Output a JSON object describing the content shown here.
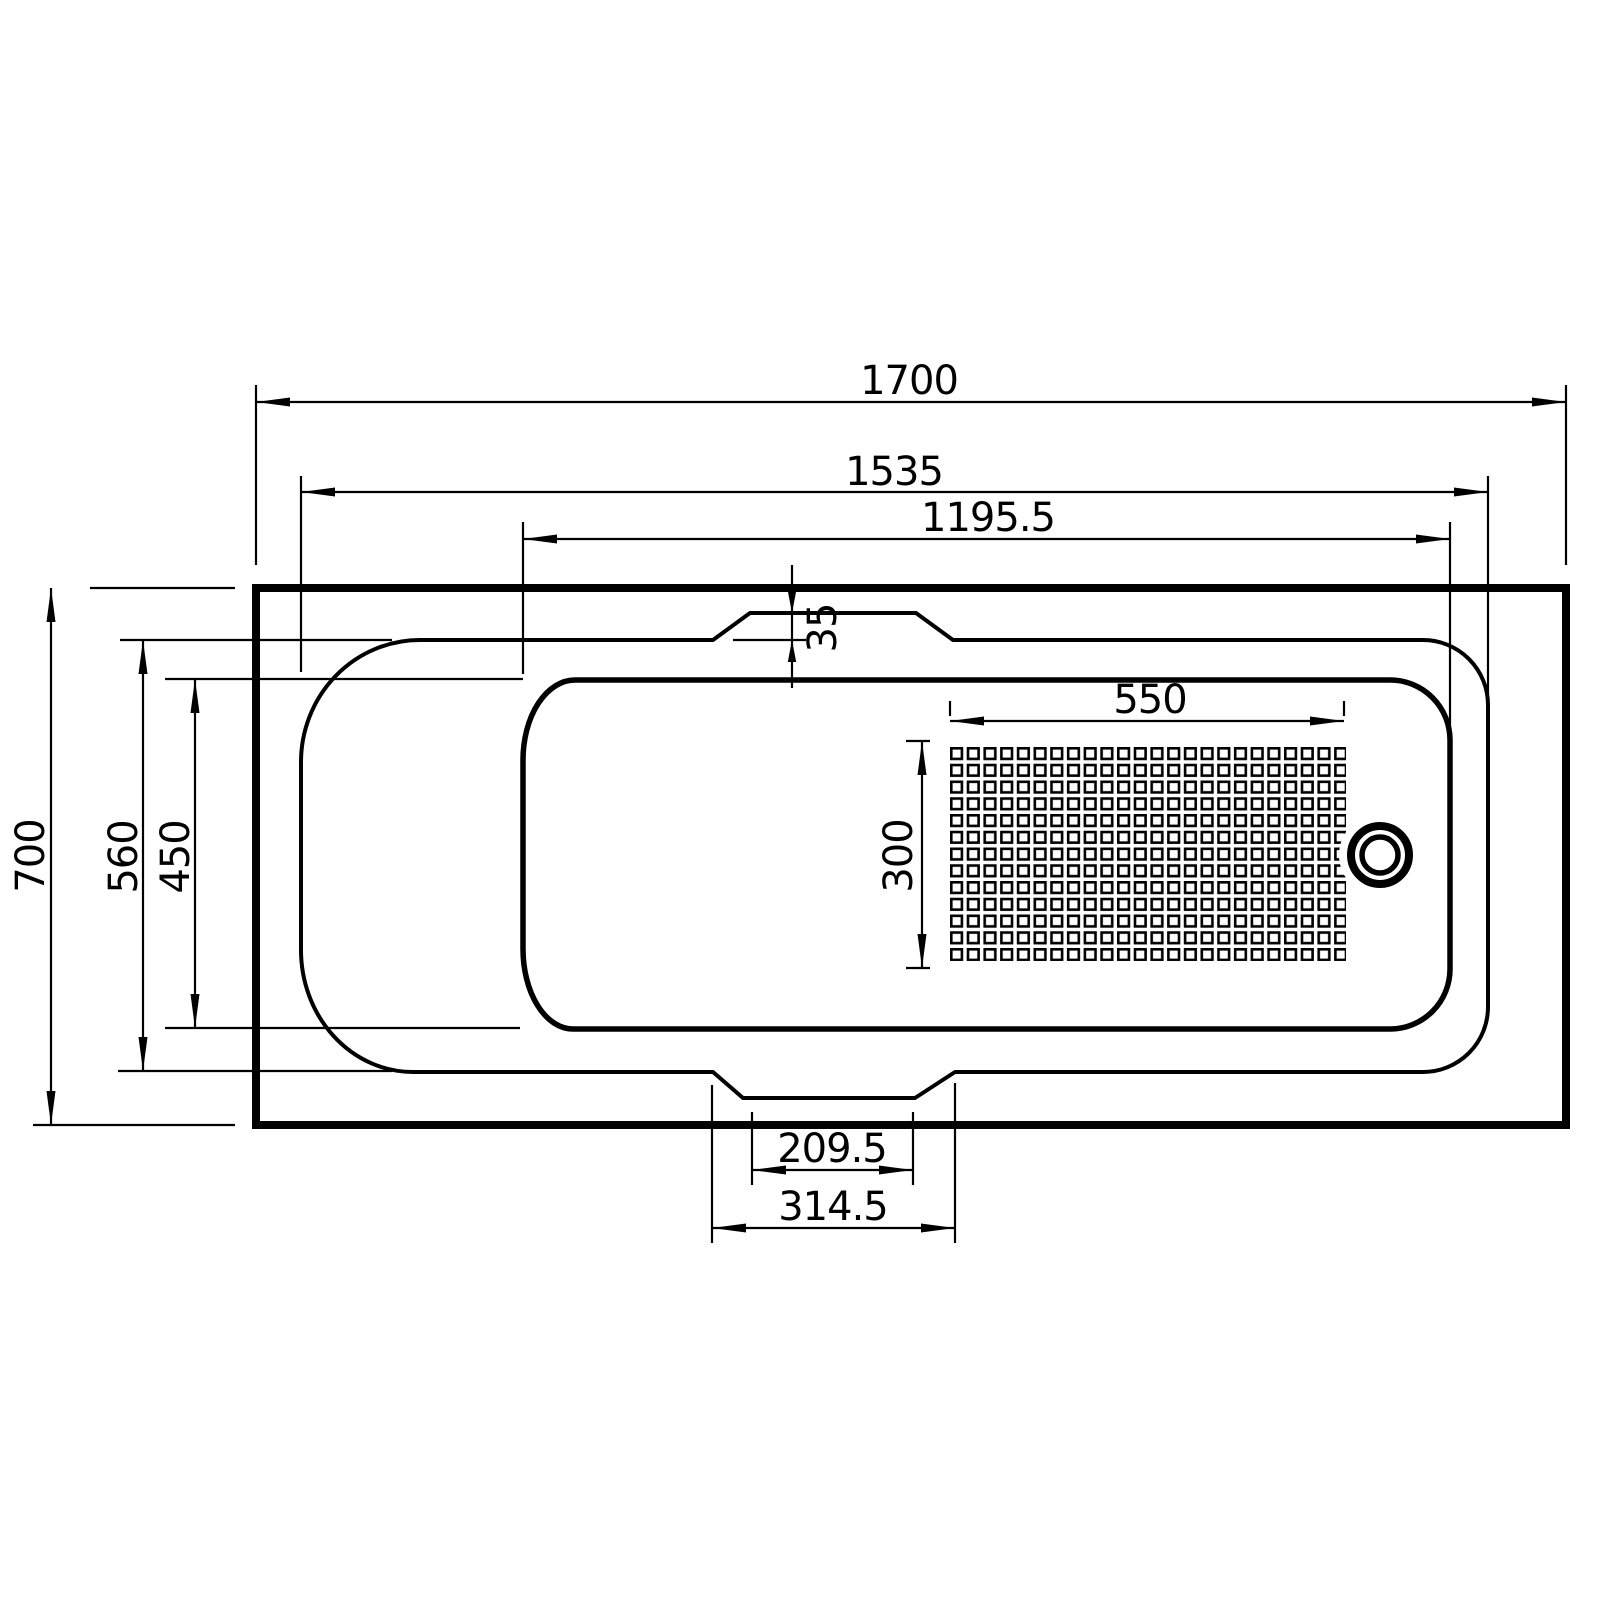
{
  "colors": {
    "background": "#ffffff",
    "line": "#000000"
  },
  "dims": {
    "overall_length": "1700",
    "deck_length": "1535",
    "basin_length": "1195.5",
    "rim_step": "35",
    "grip_area_length": "550",
    "grip_area_width": "300",
    "overall_width": "700",
    "deck_width": "560",
    "basin_width": "450",
    "foot_notch_inner": "209.5",
    "foot_notch_outer": "314.5"
  }
}
